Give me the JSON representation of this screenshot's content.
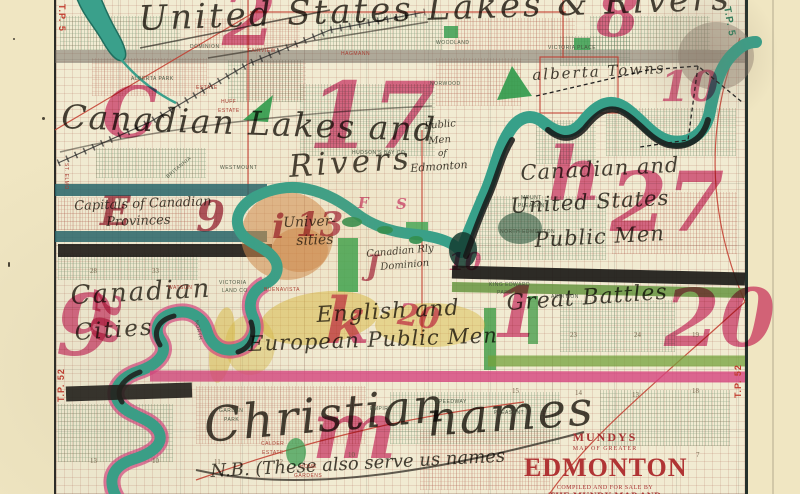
{
  "colors": {
    "paper_margin": "#f0e6c2",
    "map_paper": "#f1ebd2",
    "ink_pink": "#d6447f",
    "ink_dark_red": "#a22840",
    "ink_black": "#2e2a22",
    "river_teal": "#37a089",
    "river_shadow": "#161616",
    "band_teal": "#2d6f74",
    "band_green": "#6fa03c",
    "band_black": "#1d1b18",
    "band_magenta": "#d6447f",
    "title_red": "#b03434",
    "survey_red": "#c23b2e"
  },
  "title_block": {
    "mundys": "MUNDYS",
    "map_of": "MAP OF GREATER",
    "city": "EDMONTON",
    "compiled": "COMPILED AND FOR SALE BY",
    "company": "THE MUNDY MAP AND BLUEPRINT CO."
  },
  "handwriting": [
    {
      "n": "note-us-lakes-rivers",
      "t": "United States Lakes & Rivers",
      "x": 138,
      "y": 2,
      "s": 34,
      "r": -2,
      "ls": 3
    },
    {
      "n": "note-canadian-lakes-1",
      "t": "Canadian Lakes and",
      "x": 62,
      "y": 100,
      "s": 33,
      "r": 2,
      "ls": 2
    },
    {
      "n": "note-canadian-lakes-2",
      "t": "Rivers",
      "x": 288,
      "y": 152,
      "s": 31,
      "r": -4,
      "ls": 4
    },
    {
      "n": "note-alberta-towns",
      "t": "alberta Towns",
      "x": 532,
      "y": 68,
      "s": 15,
      "r": -3,
      "ls": 2
    },
    {
      "n": "note-can-us-public-1",
      "t": "Canadian and",
      "x": 520,
      "y": 163,
      "s": 21,
      "r": -3,
      "ls": 1
    },
    {
      "n": "note-can-us-public-2",
      "t": "United States",
      "x": 510,
      "y": 196,
      "s": 21,
      "r": -3,
      "ls": 1
    },
    {
      "n": "note-can-us-public-3",
      "t": "Public Men",
      "x": 534,
      "y": 230,
      "s": 21,
      "r": -3,
      "ls": 1
    },
    {
      "n": "note-capitals-1",
      "t": "Capitals of Canadian",
      "x": 74,
      "y": 200,
      "s": 13,
      "r": -2
    },
    {
      "n": "note-capitals-2",
      "t": "Provinces",
      "x": 106,
      "y": 216,
      "s": 13,
      "r": -2
    },
    {
      "n": "note-public-men-edm-1",
      "t": "Public",
      "x": 424,
      "y": 122,
      "s": 10,
      "r": -5
    },
    {
      "n": "note-public-men-edm-2",
      "t": "Men",
      "x": 428,
      "y": 137,
      "s": 10,
      "r": -5
    },
    {
      "n": "note-public-men-edm-3",
      "t": "of",
      "x": 438,
      "y": 150,
      "s": 9,
      "r": 0
    },
    {
      "n": "note-public-men-edm-4",
      "t": "Edmonton",
      "x": 410,
      "y": 163,
      "s": 11,
      "r": -4
    },
    {
      "n": "note-universities-1",
      "t": "Univer-",
      "x": 283,
      "y": 216,
      "s": 14,
      "r": -2
    },
    {
      "n": "note-universities-2",
      "t": "sities",
      "x": 296,
      "y": 234,
      "s": 14,
      "r": -2
    },
    {
      "n": "note-can-rly-1",
      "t": "Canadian Rly",
      "x": 366,
      "y": 250,
      "s": 10,
      "r": -5
    },
    {
      "n": "note-can-rly-2",
      "t": "Dominion",
      "x": 380,
      "y": 263,
      "s": 10,
      "r": -5
    },
    {
      "n": "note-canadian-cities-1",
      "t": "Canadian",
      "x": 70,
      "y": 283,
      "s": 26,
      "r": -3,
      "ls": 2
    },
    {
      "n": "note-canadian-cities-2",
      "t": "Cities",
      "x": 74,
      "y": 322,
      "s": 23,
      "r": -4,
      "ls": 2
    },
    {
      "n": "note-english-european-1",
      "t": "English and",
      "x": 316,
      "y": 305,
      "s": 22,
      "r": -3,
      "ls": 1
    },
    {
      "n": "note-english-european-2",
      "t": "European Public Men",
      "x": 248,
      "y": 334,
      "s": 21,
      "r": -2,
      "ls": 1
    },
    {
      "n": "note-great-battles",
      "t": "Great Battles",
      "x": 506,
      "y": 293,
      "s": 22,
      "r": -4,
      "ls": 1
    },
    {
      "n": "note-christian-names-1",
      "t": "Christian",
      "x": 202,
      "y": 402,
      "s": 48,
      "r": -5,
      "ls": 2
    },
    {
      "n": "note-christian-names-2",
      "t": "names",
      "x": 425,
      "y": 396,
      "s": 48,
      "r": -4,
      "ls": 2
    },
    {
      "n": "note-nb",
      "t": "N.B. (These also serve us names",
      "x": 210,
      "y": 463,
      "s": 18,
      "r": -3
    }
  ],
  "numbers": [
    {
      "n": "ink-number-2-top",
      "t": "2",
      "x": 222,
      "y": -20,
      "s": 78
    },
    {
      "n": "ink-number-8-top",
      "t": "8",
      "x": 596,
      "y": -16,
      "s": 62
    },
    {
      "n": "ink-letter-c",
      "t": "C",
      "x": 102,
      "y": 78,
      "s": 70
    },
    {
      "n": "ink-number-17",
      "t": "17",
      "x": 308,
      "y": 70,
      "s": 92
    },
    {
      "n": "ink-number-10-ne",
      "t": "10",
      "x": 660,
      "y": 66,
      "s": 42
    },
    {
      "n": "ink-letter-h",
      "t": "h",
      "x": 548,
      "y": 138,
      "s": 74
    },
    {
      "n": "ink-number-27",
      "t": "27",
      "x": 610,
      "y": 162,
      "s": 82
    },
    {
      "n": "ink-letter-e",
      "t": "E",
      "x": 100,
      "y": 192,
      "s": 40,
      "c": "#a22840"
    },
    {
      "n": "ink-number-9-mid",
      "t": "9",
      "x": 196,
      "y": 196,
      "s": 42,
      "c": "#a22840"
    },
    {
      "n": "ink-letter-i",
      "t": "i",
      "x": 272,
      "y": 210,
      "s": 34,
      "c": "#b03050"
    },
    {
      "n": "ink-number-13-mid",
      "t": "13",
      "x": 296,
      "y": 208,
      "s": 34,
      "c": "#b03050"
    },
    {
      "n": "ink-letter-f",
      "t": "F",
      "x": 358,
      "y": 196,
      "s": 15
    },
    {
      "n": "ink-letter-s",
      "t": "S",
      "x": 396,
      "y": 197,
      "s": 15
    },
    {
      "n": "ink-letter-j",
      "t": "J",
      "x": 366,
      "y": 252,
      "s": 28,
      "c": "#b03050"
    },
    {
      "n": "ink-number-10-mid",
      "t": "10",
      "x": 448,
      "y": 250,
      "s": 24
    },
    {
      "n": "ink-number-9-sw",
      "t": "9",
      "x": 56,
      "y": 284,
      "s": 84
    },
    {
      "n": "ink-number-20-w",
      "t": "20",
      "x": 126,
      "y": 292,
      "s": 38,
      "r": 95
    },
    {
      "n": "ink-letter-k",
      "t": "k",
      "x": 325,
      "y": 290,
      "s": 64
    },
    {
      "n": "ink-number-20-mid",
      "t": "20",
      "x": 400,
      "y": 300,
      "s": 30,
      "r": 8
    },
    {
      "n": "ink-number-1-s",
      "t": "1",
      "x": 492,
      "y": 278,
      "s": 70
    },
    {
      "n": "ink-number-20-se",
      "t": "20",
      "x": 664,
      "y": 278,
      "s": 80
    },
    {
      "n": "ink-letter-m",
      "t": "m",
      "x": 312,
      "y": 390,
      "s": 80
    }
  ],
  "map_labels": [
    {
      "t": "DOMINION",
      "x": 190,
      "y": 45
    },
    {
      "t": "FAIRVIEW",
      "x": 248,
      "y": 49,
      "c": "#a8392e"
    },
    {
      "t": "ALBERTA PARK",
      "x": 131,
      "y": 77
    },
    {
      "t": "ESTATE",
      "x": 196,
      "y": 86,
      "c": "#a8392e"
    },
    {
      "t": "HUFF",
      "x": 221,
      "y": 100,
      "c": "#a8392e"
    },
    {
      "t": "ESTATE",
      "x": 218,
      "y": 109,
      "c": "#a8392e"
    },
    {
      "t": "HAGMANN",
      "x": 341,
      "y": 52,
      "c": "#a8392e"
    },
    {
      "t": "WOODLAND",
      "x": 436,
      "y": 41
    },
    {
      "t": "VICTORIA PLACE",
      "x": 548,
      "y": 46
    },
    {
      "t": "BRITANNIA",
      "x": 166,
      "y": 176,
      "r": -40
    },
    {
      "t": "WESTMOUNT",
      "x": 220,
      "y": 166
    },
    {
      "t": "NORWOOD",
      "x": 430,
      "y": 82
    },
    {
      "t": "HUDSON'S BAY CO",
      "x": 352,
      "y": 151
    },
    {
      "t": "MOUNT",
      "x": 521,
      "y": 196
    },
    {
      "t": "PLEASANT",
      "x": 518,
      "y": 204
    },
    {
      "t": "NORTH EDMONTON",
      "x": 500,
      "y": 230
    },
    {
      "t": "BUENAVISTA",
      "x": 264,
      "y": 288,
      "c": "#a8392e"
    },
    {
      "t": "VICTORIA",
      "x": 219,
      "y": 281
    },
    {
      "t": "LAND CO",
      "x": 222,
      "y": 289
    },
    {
      "t": "WATSON",
      "x": 168,
      "y": 286,
      "c": "#a8392e"
    },
    {
      "t": "KING EDWARD",
      "x": 489,
      "y": 283
    },
    {
      "t": "PARK",
      "x": 497,
      "y": 291
    },
    {
      "t": "ADDITION",
      "x": 551,
      "y": 295
    },
    {
      "t": "SPEEDWAY",
      "x": 435,
      "y": 400
    },
    {
      "t": "PLEASANT",
      "x": 494,
      "y": 411
    },
    {
      "t": "GARDEN",
      "x": 219,
      "y": 409
    },
    {
      "t": "PARK",
      "x": 224,
      "y": 418
    },
    {
      "t": "EMPIRE",
      "x": 370,
      "y": 407
    },
    {
      "t": "CALDER",
      "x": 261,
      "y": 442,
      "c": "#a8392e"
    },
    {
      "t": "ESTATE",
      "x": 262,
      "y": 451,
      "c": "#a8392e"
    },
    {
      "t": "HOME",
      "x": 300,
      "y": 465,
      "c": "#a8392e"
    },
    {
      "t": "GARDENS",
      "x": 294,
      "y": 474,
      "c": "#a8392e"
    },
    {
      "t": "NORTH",
      "x": 198,
      "y": 320,
      "r": 78
    },
    {
      "t": "ST. ELMO",
      "x": 68,
      "y": 163,
      "r": 90,
      "c": "#a8392e"
    }
  ],
  "section_numbers": [
    {
      "t": "28",
      "x": 90,
      "y": 268
    },
    {
      "t": "33",
      "x": 152,
      "y": 268
    },
    {
      "t": "23",
      "x": 570,
      "y": 332
    },
    {
      "t": "24",
      "x": 634,
      "y": 332
    },
    {
      "t": "19",
      "x": 692,
      "y": 332
    },
    {
      "t": "15",
      "x": 512,
      "y": 388
    },
    {
      "t": "14",
      "x": 575,
      "y": 390
    },
    {
      "t": "13",
      "x": 632,
      "y": 392
    },
    {
      "t": "18",
      "x": 692,
      "y": 388
    },
    {
      "t": "13",
      "x": 90,
      "y": 458
    },
    {
      "t": "10",
      "x": 152,
      "y": 458
    },
    {
      "t": "11",
      "x": 214,
      "y": 459
    },
    {
      "t": "12",
      "x": 276,
      "y": 459
    },
    {
      "t": "10",
      "x": 348,
      "y": 452
    },
    {
      "t": "7",
      "x": 696,
      "y": 452
    }
  ],
  "edge_labels": [
    {
      "t": "T.P. 5",
      "x": 66,
      "y": 4,
      "r": 90,
      "c": "#c23b2e",
      "s": 9
    },
    {
      "t": "T.P. 5",
      "x": 731,
      "y": 6,
      "r": 80,
      "c": "#2e7d5b",
      "s": 10
    },
    {
      "t": "T.P. 52",
      "x": 57,
      "y": 402,
      "r": -90,
      "c": "#c23b2e",
      "s": 9
    },
    {
      "t": "T.P. 52",
      "x": 734,
      "y": 398,
      "r": -90,
      "c": "#c23b2e",
      "s": 9
    }
  ]
}
